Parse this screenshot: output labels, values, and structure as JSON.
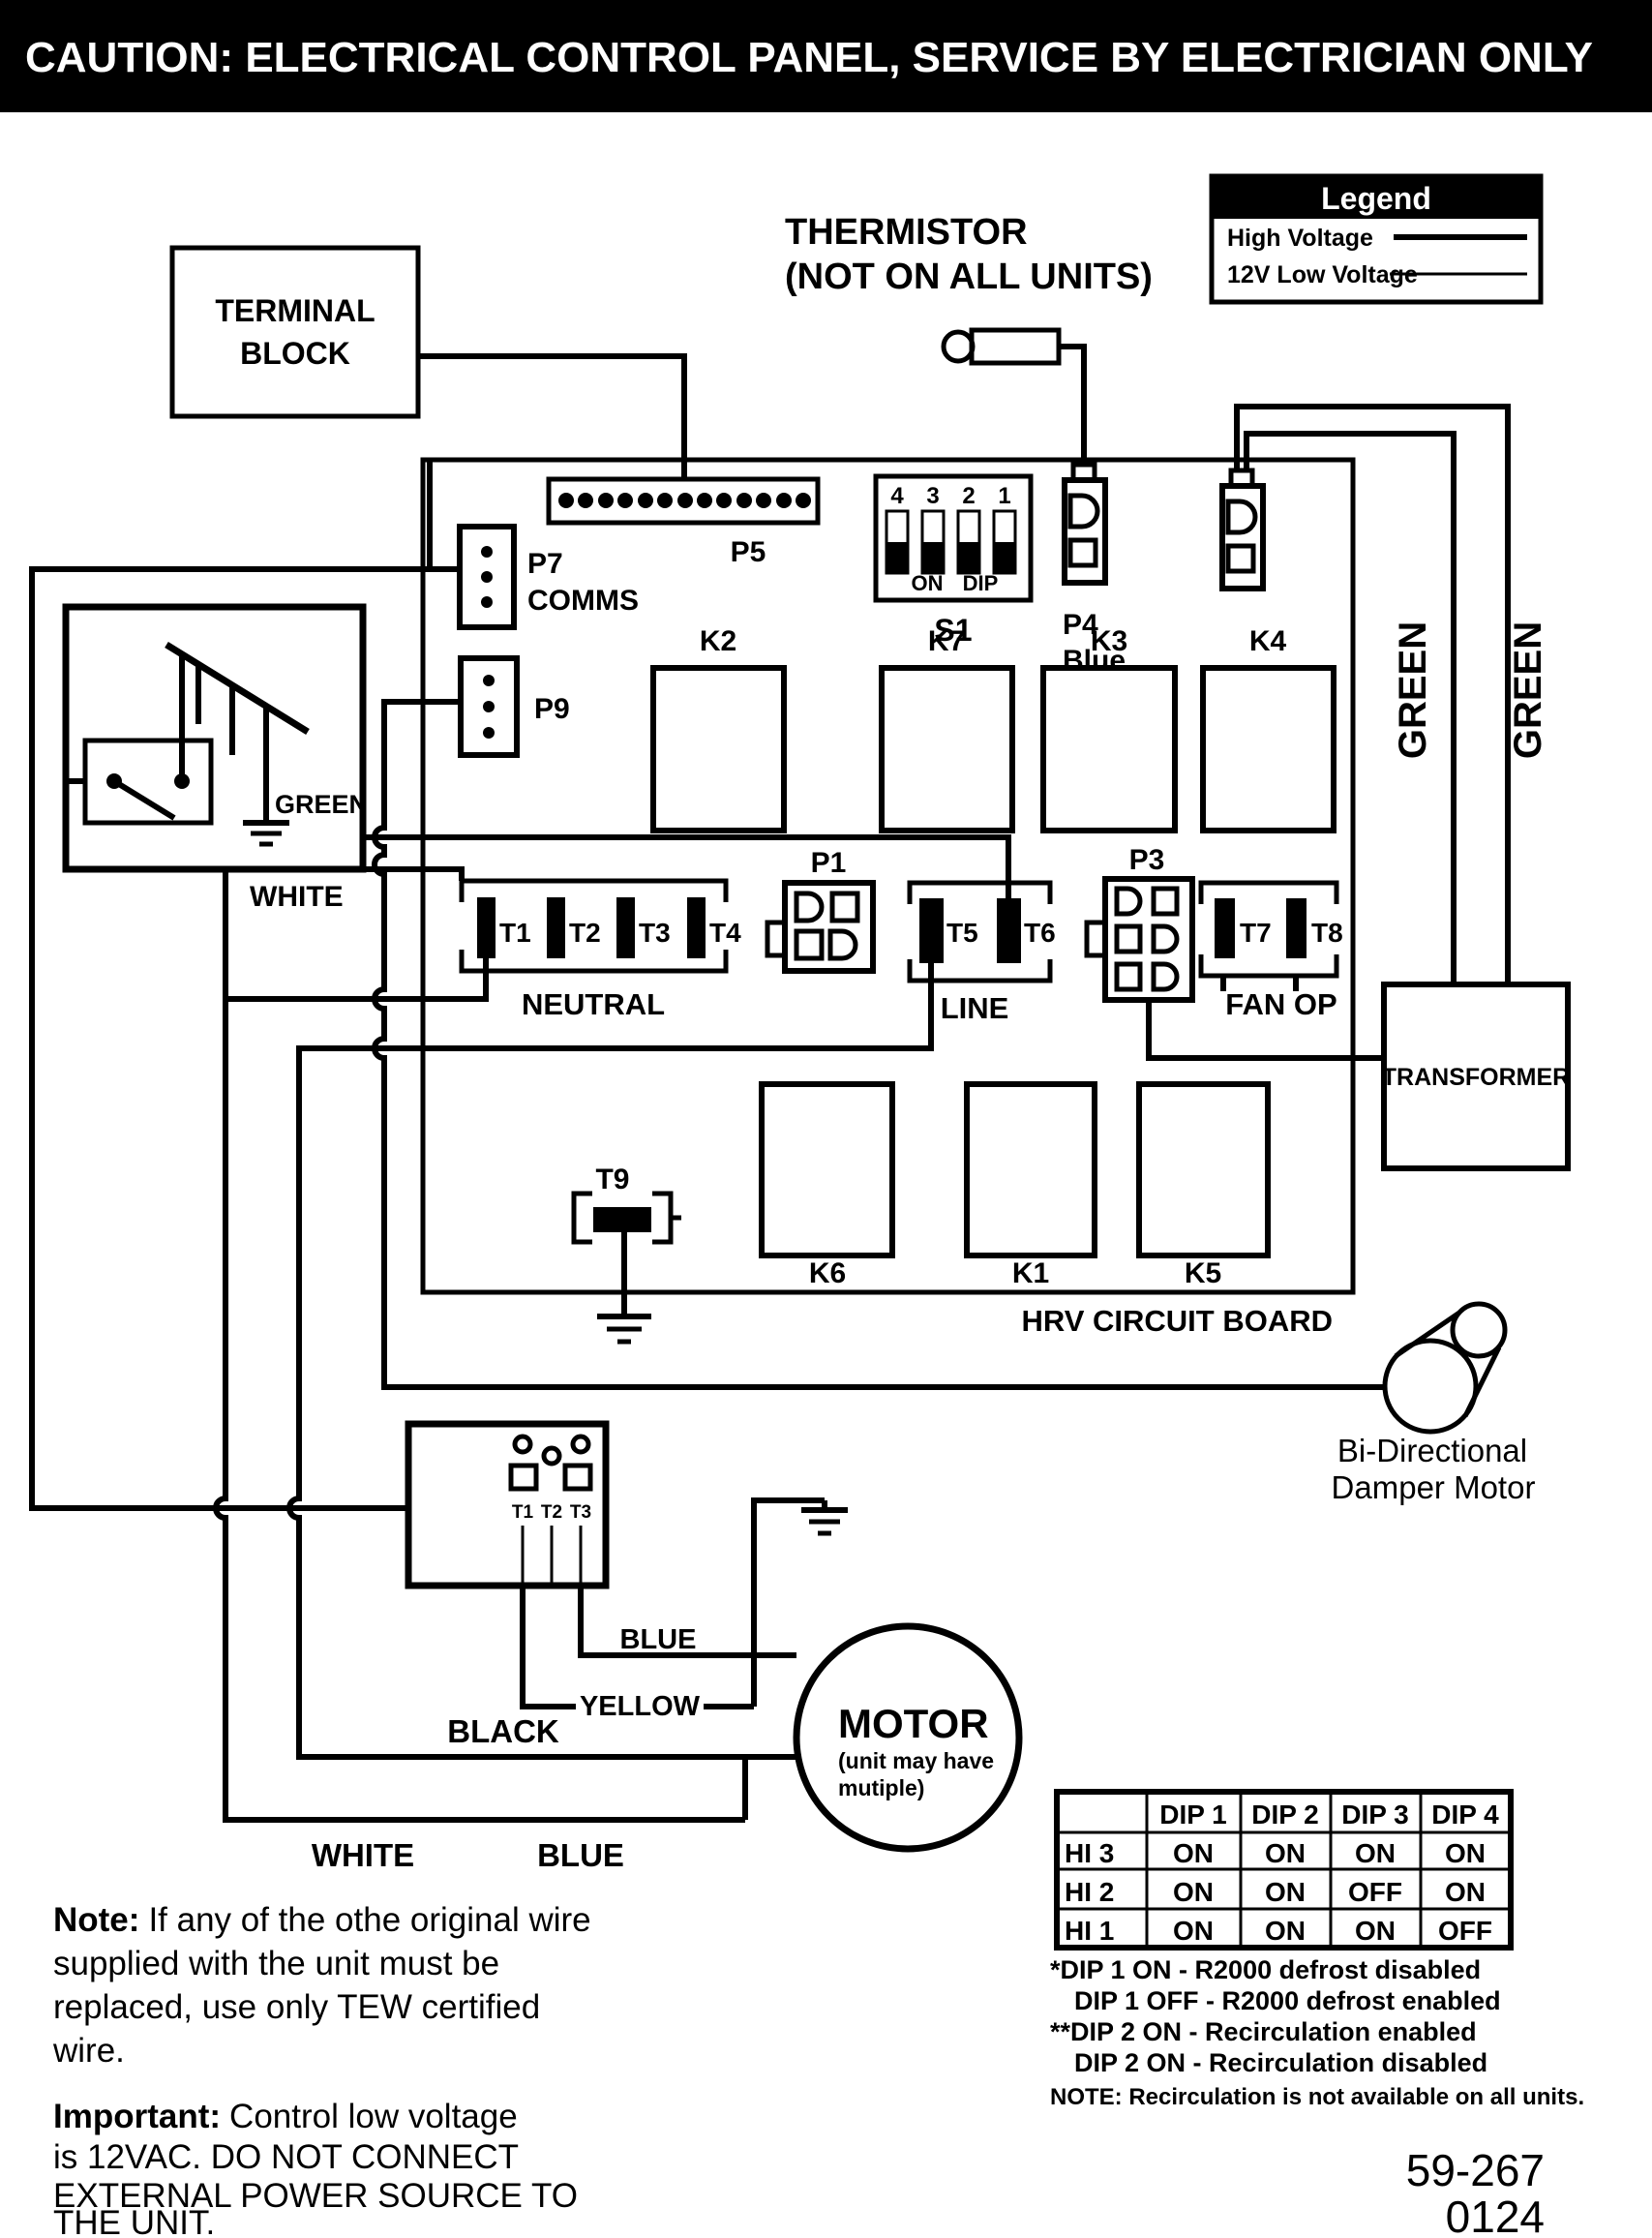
{
  "title": {
    "prefix": "CAUTION:",
    "text": " ELECTRICAL CONTROL PANEL, SERVICE  BY ELECTRICIAN ONLY"
  },
  "legend": {
    "header": "Legend",
    "high_voltage": "High Voltage",
    "low_voltage": "12V Low Voltage"
  },
  "terminal_block": {
    "line1": "TERMINAL",
    "line2": "BLOCK"
  },
  "thermistor": {
    "line1": "THERMISTOR",
    "line2": "(NOT ON ALL UNITS)"
  },
  "connectors": {
    "p5": "P5",
    "p7": "P7",
    "p7_sub": "COMMS",
    "p9": "P9",
    "p1": "P1",
    "p3": "P3",
    "p4": "P4",
    "p4_color": "Blue",
    "s1": "S1"
  },
  "dip_switch": {
    "numbers": [
      "4",
      "3",
      "2",
      "1"
    ],
    "on": "ON",
    "dip": "DIP"
  },
  "relays": {
    "k2": "K2",
    "k7": "K7",
    "k3": "K3",
    "k4": "K4",
    "k6": "K6",
    "k1": "K1",
    "k5": "K5"
  },
  "terminals": {
    "t1": "T1",
    "t2": "T2",
    "t3": "T3",
    "t4": "T4",
    "t5": "T5",
    "t6": "T6",
    "t7": "T7",
    "t8": "T8",
    "t9": "T9",
    "neutral": "NEUTRAL",
    "line": "LINE",
    "fan_op": "FAN OP"
  },
  "wires": {
    "green_left": "GREEN",
    "white_left": "WHITE",
    "green_right_1": "GREEN",
    "green_right_2": "GREEN",
    "blue": "BLUE",
    "yellow": "YELLOW",
    "black": "BLACK",
    "white_bottom": "WHITE",
    "blue_bottom": "BLUE"
  },
  "board": {
    "name": "HRV CIRCUIT BOARD",
    "transformer": "TRANSFORMER"
  },
  "damper": {
    "line1": "Bi-Directional",
    "line2": "Damper Motor"
  },
  "motor": {
    "name": "MOTOR",
    "sub1": "(unit may have",
    "sub2": "mutiple)",
    "t1": "T1",
    "t2": "T2",
    "t3": "T3"
  },
  "dip_table": {
    "col_headers": [
      "DIP 1",
      "DIP 2",
      "DIP 3",
      "DIP 4"
    ],
    "rows": [
      {
        "label": "HI 3",
        "values": [
          "ON",
          "ON",
          "ON",
          "ON"
        ]
      },
      {
        "label": "HI 2",
        "values": [
          "ON",
          "ON",
          "OFF",
          "ON"
        ]
      },
      {
        "label": "HI 1",
        "values": [
          "ON",
          "ON",
          "ON",
          "OFF"
        ]
      }
    ]
  },
  "footnotes": {
    "f1": "*DIP 1 ON - R2000 defrost disabled",
    "f2": "DIP 1 OFF - R2000 defrost enabled",
    "f3": "**DIP 2 ON - Recirculation enabled",
    "f4": "DIP 2 ON - Recirculation disabled",
    "f5": "NOTE: Recirculation is not available on all units."
  },
  "notes": {
    "note_prefix": "Note:",
    "note_l1": "If any of the othe original wire",
    "note_l2": "supplied with the unit must be",
    "note_l3": "replaced, use only TEW certified",
    "note_l4": "wire.",
    "imp_prefix": "Important:",
    "imp_l1": "Control low voltage",
    "imp_l2": "is 12VAC. DO NOT CONNECT",
    "imp_l3": "EXTERNAL POWER SOURCE TO",
    "imp_l4": "THE UNIT."
  },
  "part_number": {
    "line1": "59-267",
    "line2": "0124"
  },
  "colors": {
    "ink": "#000000",
    "background": "#ffffff"
  }
}
